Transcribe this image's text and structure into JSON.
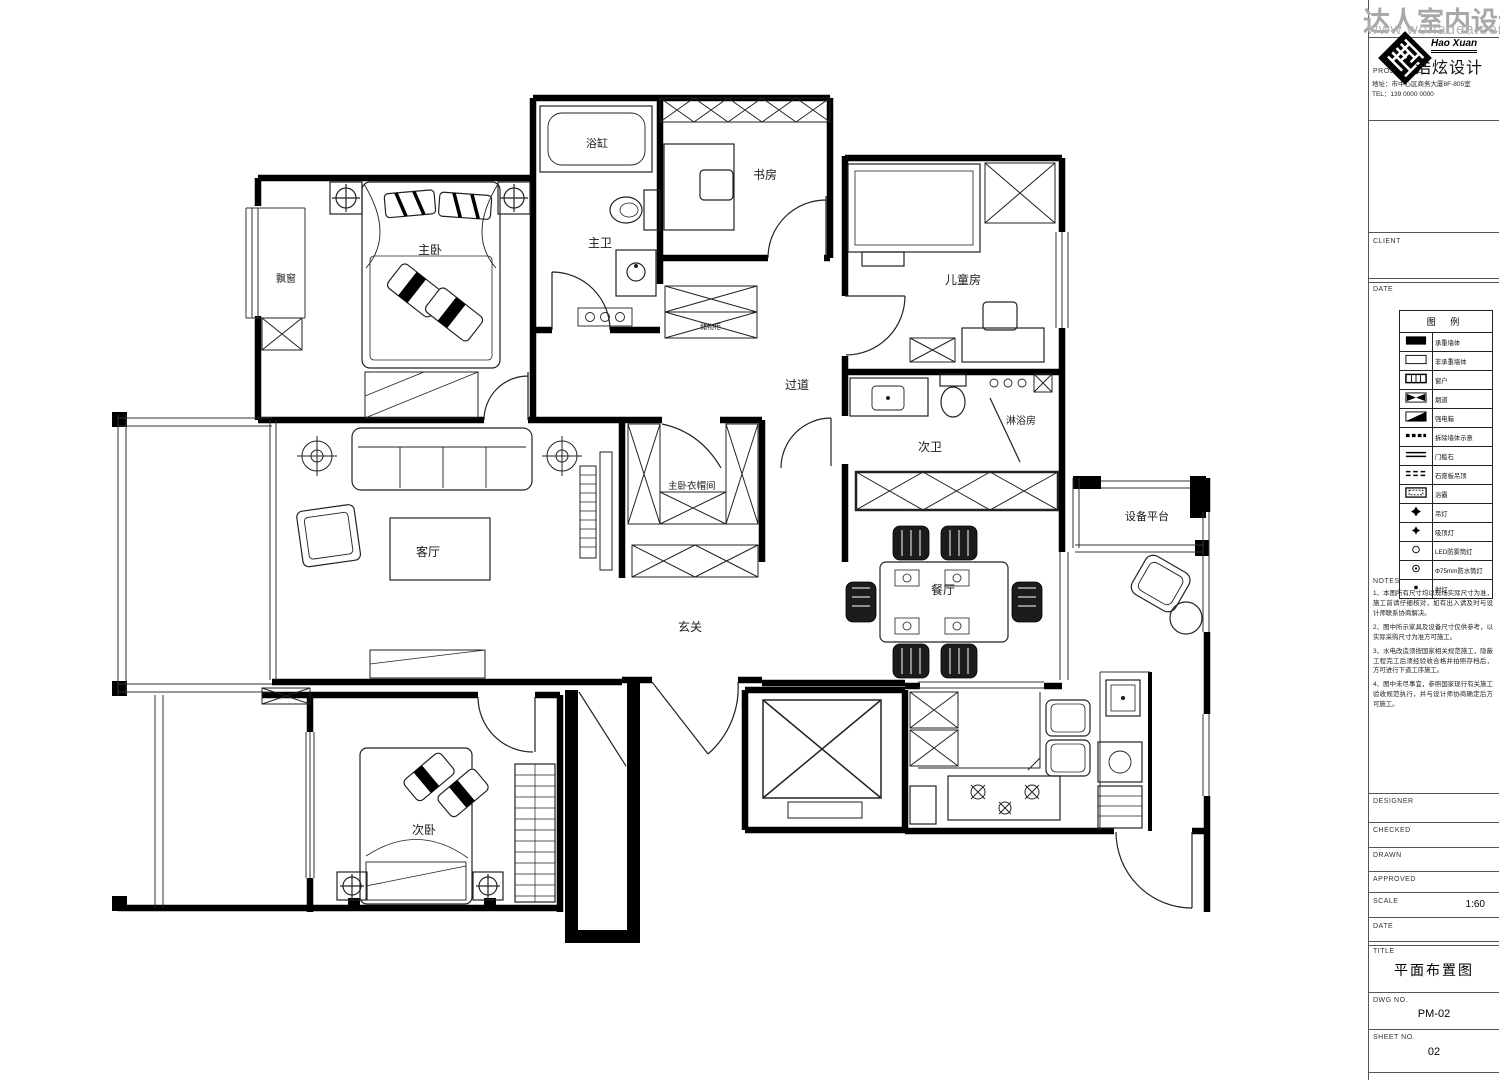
{
  "watermark": {
    "title": "达人室内设计网",
    "url": "www.wonadea.com"
  },
  "plan": {
    "labels": {
      "bay_window": "飘窗",
      "master_bedroom": "主卧",
      "bathtub": "浴缸",
      "master_bath": "主卫",
      "study": "书房",
      "kids_room": "儿童房",
      "hallway": "过道",
      "second_bath": "次卫",
      "shower_room": "淋浴房",
      "closet": "主卧衣帽间",
      "entry": "玄关",
      "living_room": "客厅",
      "dining_room": "餐厅",
      "equipment_platform": "设备平台",
      "second_bedroom": "次卧",
      "cabinet_note": "储物柜"
    }
  },
  "titleblock": {
    "project_no_label": "PROJECT NO.",
    "brand": {
      "name_en": "Hao Xuan",
      "name_cn": "浩炫设计",
      "address": "地址：市中心区商务大厦8F-805室",
      "tel": "TEL：139 0000 0000"
    },
    "client_label": "CLIENT",
    "date_label": "DATE",
    "legend": {
      "title": "图 例",
      "rows": [
        {
          "symbol": "filled-rect",
          "label": "承重墙体"
        },
        {
          "symbol": "hollow-rect",
          "label": "非承重墙体"
        },
        {
          "symbol": "window",
          "label": "窗户"
        },
        {
          "symbol": "bowtie",
          "label": "烟道"
        },
        {
          "symbol": "half-diagonal",
          "label": "强电箱"
        },
        {
          "symbol": "dash-blocks",
          "label": "拆除墙体示意"
        },
        {
          "symbol": "double-line",
          "label": "门槛石"
        },
        {
          "symbol": "dashed-line",
          "label": "石膏板吊顶"
        },
        {
          "symbol": "rect-in-rect",
          "label": "浴霸"
        },
        {
          "symbol": "star-diamond",
          "label": "吊灯"
        },
        {
          "symbol": "star-diamond-small",
          "label": "吸顶灯"
        },
        {
          "symbol": "circle",
          "label": "LED防雾筒灯"
        },
        {
          "symbol": "circle-dot",
          "label": "Φ75mm防水筒灯"
        },
        {
          "symbol": "dot",
          "label": "射灯"
        }
      ]
    },
    "notes": {
      "title": "NOTES",
      "items": [
        "1、本图所有尺寸均以现场实际尺寸为准，施工前请仔细核对，如有出入请及时与设计师联系协商解决。",
        "2、图中所示家具及设备尺寸仅供参考，以实际采购尺寸为准方可施工。",
        "3、水电改造须按国家相关规范施工，隐蔽工程完工后须经验收合格并拍照存档后，方可进行下道工序施工。",
        "4、图中未尽事宜，参照国家现行有关施工验收规范执行，并与设计师协商确定后方可施工。"
      ]
    },
    "fields": {
      "designer": "DESIGNER",
      "checked": "CHECKED",
      "drawn": "DRAWN",
      "approved": "APPROVED",
      "scale_label": "SCALE",
      "scale_value": "1:60",
      "date2_label": "DATE",
      "title_label": "TITLE",
      "drawing_title": "平面布置图",
      "dwg_label": "DWG NO.",
      "dwg_value": "PM-02",
      "sheet_label": "SHEET NO.",
      "sheet_value": "02"
    }
  }
}
